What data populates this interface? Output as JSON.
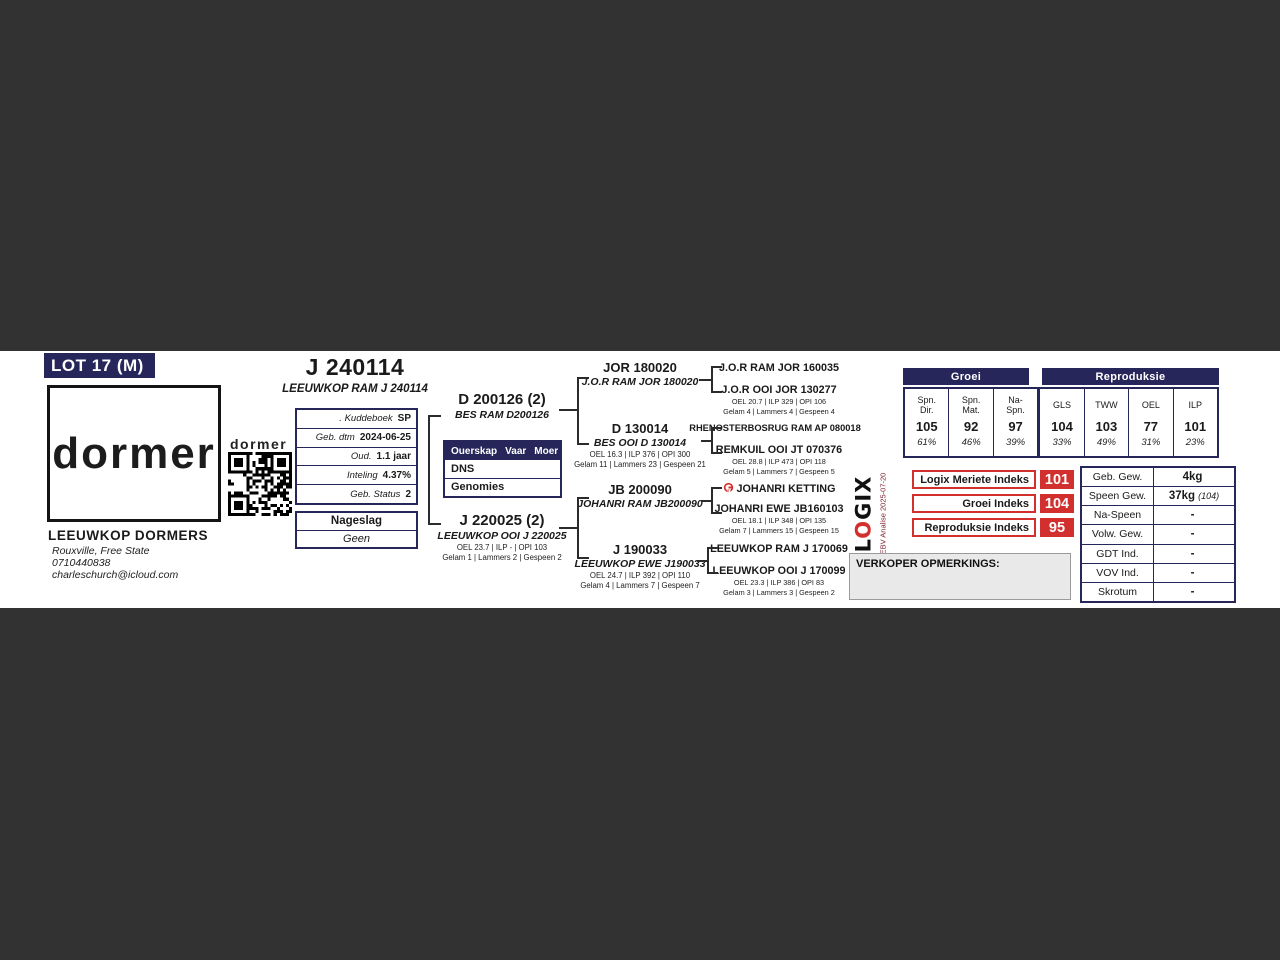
{
  "lot": {
    "badge": "LOT 17 (M)"
  },
  "animal": {
    "id": "J 240114",
    "full_name": "LEEUWKOP RAM J 240114"
  },
  "breeder": {
    "brand_large": "dormer",
    "brand_small": "dormer",
    "name": "LEEUWKOP DORMERS",
    "location": "Rouxville, Free State",
    "phone": "0710440838",
    "email": "charleschurch@icloud.com"
  },
  "details": {
    "rows": [
      {
        "label": ". Kuddeboek",
        "value": "SP"
      },
      {
        "label": "Geb. dtm",
        "value": "2024-06-25"
      },
      {
        "label": "Oud.",
        "value": "1.1 jaar"
      },
      {
        "label": "Inteling",
        "value": "4.37%"
      },
      {
        "label": "Geb. Status",
        "value": "2"
      }
    ]
  },
  "nageslag": {
    "title": "Nageslag",
    "value": "Geen"
  },
  "parentage": {
    "header": {
      "c1": "Ouerskap",
      "c2": "Vaar",
      "c3": "Moer"
    },
    "rows": [
      {
        "label": "DNS"
      },
      {
        "label": "Genomies"
      }
    ]
  },
  "pedigree": {
    "sire": {
      "id": "D 200126 (2)",
      "reg": "BES RAM D200126"
    },
    "dam": {
      "id": "J 220025 (2)",
      "reg": "LEEUWKOP OOI J 220025",
      "stats1": "OEL 23.7 | ILP - | OPI 103",
      "stats2": "Gelam 1 | Lammers 2 | Gespeen 2"
    },
    "grandparents": [
      {
        "id": "JOR 180020",
        "reg": "J.O.R RAM JOR 180020",
        "stats1": "",
        "stats2": ""
      },
      {
        "id": "D 130014",
        "reg": "BES OOI D 130014",
        "stats1": "OEL 16.3 | ILP 376 | OPI 300",
        "stats2": "Gelam 11 | Lammers 23 | Gespeen 21"
      },
      {
        "id": "JB 200090",
        "reg": "JOHANRI RAM JB200090",
        "stats1": "",
        "stats2": ""
      },
      {
        "id": "J 190033",
        "reg": "LEEUWKOP EWE J190033",
        "stats1": "OEL 24.7 | ILP 392 | OPI 110",
        "stats2": "Gelam 4 | Lammers 7 | Gespeen 7"
      }
    ],
    "great_grandparents": [
      {
        "name": "J.O.R RAM JOR 160035",
        "stats1": "",
        "stats2": ""
      },
      {
        "name": "J.O.R OOI JOR 130277",
        "stats1": "OEL 20.7 | ILP 329 | OPI 106",
        "stats2": "Gelam 4 | Lammers 4 | Gespeen 4"
      },
      {
        "name": "RHENOSTERBOSRUG RAM AP 080018",
        "stats1": "",
        "stats2": ""
      },
      {
        "name": "REMKUIL OOI JT 070376",
        "stats1": "OEL 28.8 | ILP 473 | OPI 118",
        "stats2": "Gelam 5 | Lammers 7 | Gespeen 5"
      },
      {
        "name": "JOHANRI KETTING",
        "stats1": "",
        "stats2": ""
      },
      {
        "name": "JOHANRI EWE JB160103",
        "stats1": "OEL 18.1 | ILP 348 | OPI 135",
        "stats2": "Gelam 7 | Lammers 15 | Gespeen 15"
      },
      {
        "name": "LEEUWKOP RAM J 170069",
        "stats1": "",
        "stats2": ""
      },
      {
        "name": "LEEUWKOP OOI J 170099",
        "stats1": "OEL 23.3 | ILP 386 | OPI 83",
        "stats2": "Gelam 3 | Lammers 3 | Gespeen 2"
      }
    ]
  },
  "chart_data": {
    "type": "table",
    "title": "EBV indekse",
    "groups": [
      {
        "title": "Groei",
        "columns": [
          "Spn. Dir.",
          "Spn. Mat.",
          "Na- Spn."
        ],
        "values": [
          105,
          92,
          97
        ],
        "accuracies": [
          "61%",
          "46%",
          "39%"
        ]
      },
      {
        "title": "Reproduksie",
        "columns": [
          "GLS",
          "TWW",
          "OEL",
          "ILP"
        ],
        "values": [
          104,
          103,
          77,
          101
        ],
        "accuracies": [
          "33%",
          "49%",
          "31%",
          "23%"
        ]
      }
    ]
  },
  "indices_table": {
    "groei_title": "Groei",
    "repro_title": "Reproduksie",
    "cells": [
      {
        "label": "Spn. Dir.",
        "value": "105",
        "acc": "61%"
      },
      {
        "label": "Spn. Mat.",
        "value": "92",
        "acc": "46%"
      },
      {
        "label": "Na- Spn.",
        "value": "97",
        "acc": "39%"
      },
      {
        "label": "GLS",
        "value": "104",
        "acc": "33%"
      },
      {
        "label": "TWW",
        "value": "103",
        "acc": "49%"
      },
      {
        "label": "OEL",
        "value": "77",
        "acc": "31%"
      },
      {
        "label": "ILP",
        "value": "101",
        "acc": "23%"
      }
    ]
  },
  "index_badges": [
    {
      "label": "Logix Meriete Indeks",
      "value": "101"
    },
    {
      "label": "Groei Indeks",
      "value": "104"
    },
    {
      "label": "Reproduksie Indeks",
      "value": "95"
    }
  ],
  "logix": {
    "l": "L",
    "o": "O",
    "gix": "GIX",
    "analysis": "EBV Analise 2025-07-20"
  },
  "verkoper": {
    "label": "VERKOPER OPMERKINGS:"
  },
  "weights": {
    "rows": [
      {
        "label": "Geb. Gew.",
        "value": "4kg",
        "note": ""
      },
      {
        "label": "Speen Gew.",
        "value": "37kg",
        "note": "(104)"
      },
      {
        "label": "Na-Speen",
        "value": "-",
        "note": ""
      },
      {
        "label": "Volw. Gew.",
        "value": "-",
        "note": ""
      },
      {
        "label": "GDT Ind.",
        "value": "-",
        "note": ""
      },
      {
        "label": "VOV Ind.",
        "value": "-",
        "note": ""
      },
      {
        "label": "Skrotum",
        "value": "-",
        "note": ""
      }
    ]
  }
}
